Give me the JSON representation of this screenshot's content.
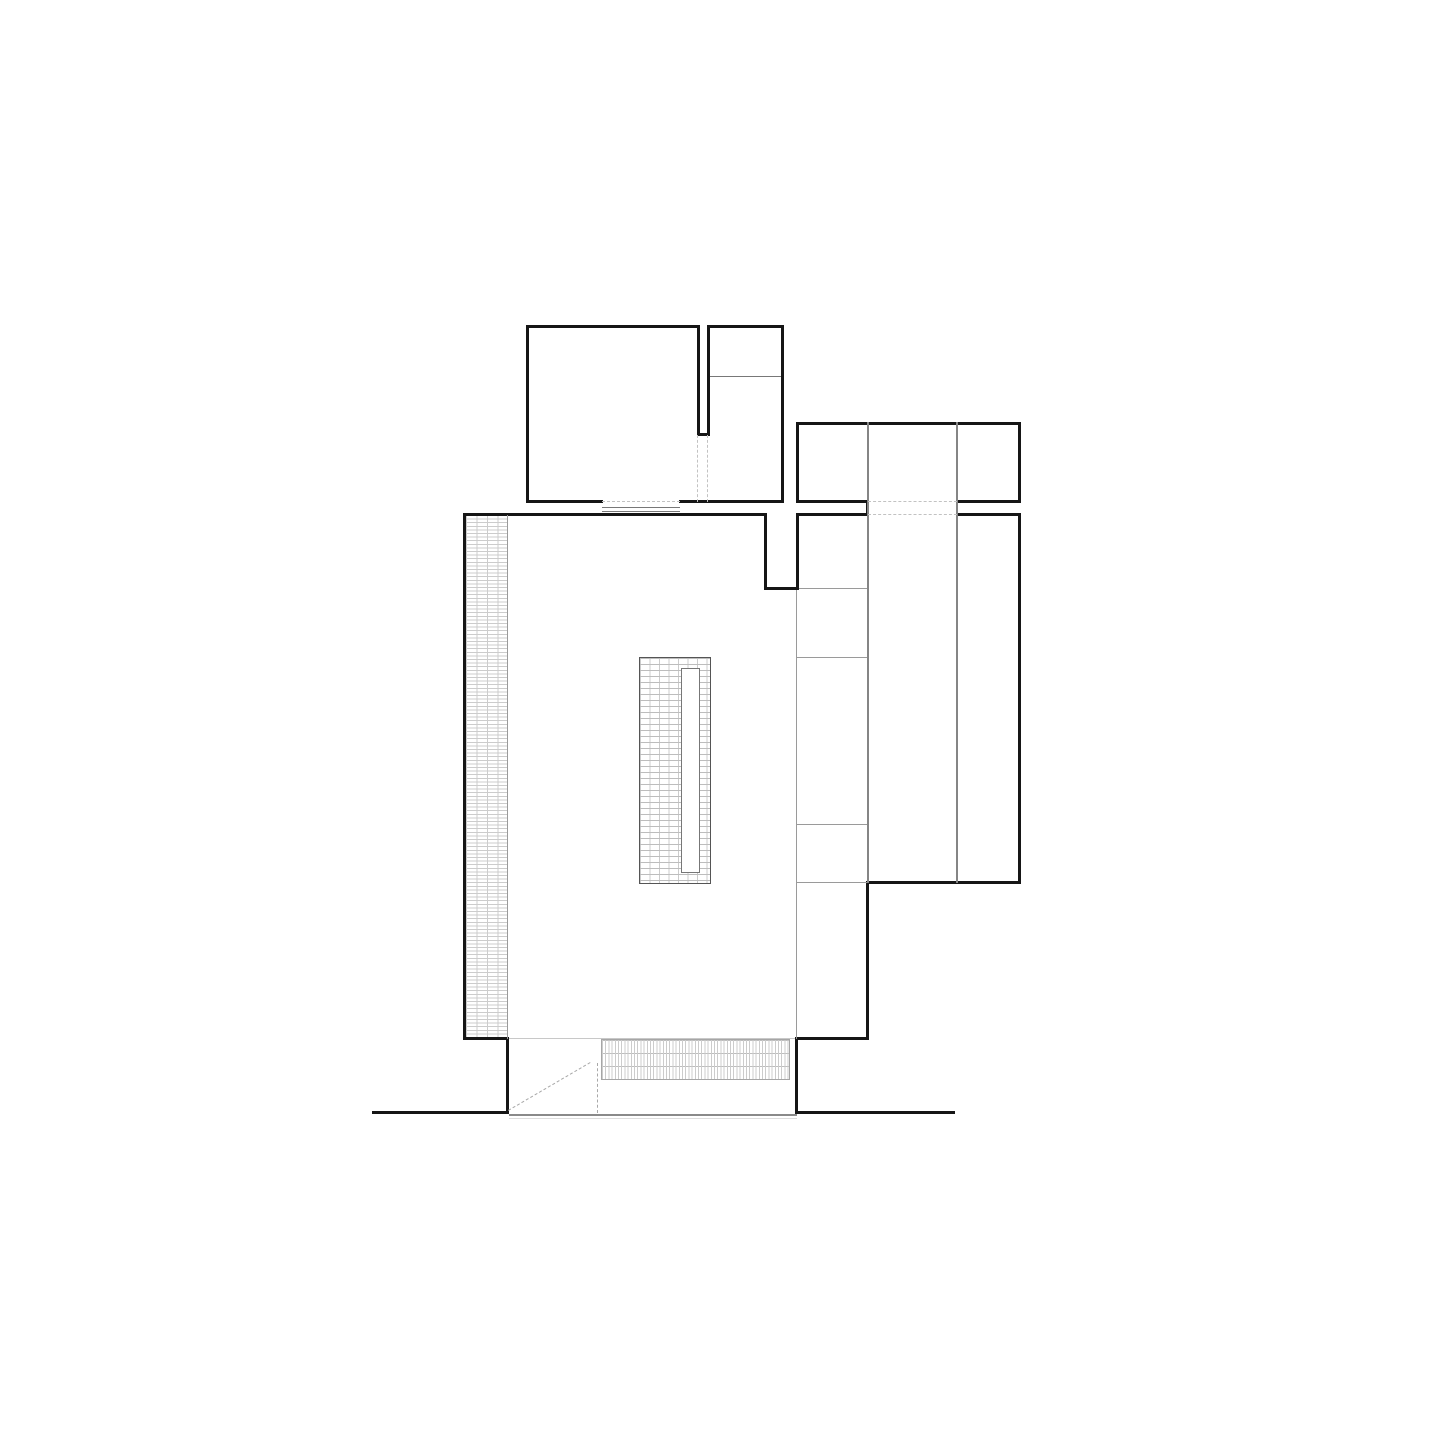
{
  "plan": {
    "canvas": {
      "w": 1440,
      "h": 1440,
      "bg": "#ffffff"
    },
    "styles": {
      "wall_color": "#161616",
      "medium_color": "#858585",
      "thin_color": "#9a9a9a",
      "thin2_color": "#787878",
      "light_color": "#dddddd",
      "dash_color": "#c2c2c2",
      "door_color": "#a8a8a8",
      "hatch_line": "#cccccc",
      "hatch_line2": "#bdbdbd",
      "island_outline": "#555555",
      "slot_outline": "#777777",
      "threshold_color": "#8a8a8a",
      "floor_line": "#c8c8c8"
    },
    "hatches": [
      {
        "name": "west-wall-hatch",
        "t": "hatch-grid",
        "x": 466,
        "y": 515,
        "w": 42,
        "h": 524
      },
      {
        "name": "entry-floor-hatch",
        "t": "hatch-vbands",
        "x": 601,
        "y": 1039,
        "w": 189,
        "h": 41
      },
      {
        "name": "island-hatch",
        "t": "hatch-brick",
        "x": 639,
        "y": 657,
        "w": 72,
        "h": 227
      },
      {
        "name": "island-slot",
        "t": "slot",
        "x": 681,
        "y": 668,
        "w": 19,
        "h": 205
      }
    ],
    "segments": [
      {
        "name": "room-nw-top-wall-west",
        "t": "wall",
        "x": 526,
        "y": 325,
        "w": 174,
        "h": 3
      },
      {
        "name": "room-nw-top-wall-east",
        "t": "wall",
        "x": 707,
        "y": 325,
        "w": 77,
        "h": 3
      },
      {
        "name": "room-nw-west-wall",
        "t": "wall",
        "x": 526,
        "y": 325,
        "w": 3,
        "h": 178
      },
      {
        "name": "room-nw-east-wall",
        "t": "wall",
        "x": 781,
        "y": 325,
        "w": 3,
        "h": 178
      },
      {
        "name": "room-nw-south-wall-west",
        "t": "wall",
        "x": 526,
        "y": 500,
        "w": 77,
        "h": 3
      },
      {
        "name": "room-nw-south-wall-east",
        "t": "wall",
        "x": 679,
        "y": 500,
        "w": 105,
        "h": 3
      },
      {
        "name": "room-nw-slot-west-wall",
        "t": "wall",
        "x": 697,
        "y": 325,
        "w": 3,
        "h": 110
      },
      {
        "name": "room-nw-slot-east-wall",
        "t": "wall",
        "x": 707,
        "y": 325,
        "w": 3,
        "h": 110
      },
      {
        "name": "room-nw-slot-end-wall",
        "t": "wall",
        "x": 697,
        "y": 433,
        "w": 13,
        "h": 3
      },
      {
        "name": "room-nw-divider-line",
        "t": "thin2",
        "x": 710,
        "y": 376,
        "w": 71,
        "h": 1
      },
      {
        "name": "block-ne-top-wall",
        "t": "wall",
        "x": 796,
        "y": 422,
        "w": 225,
        "h": 3
      },
      {
        "name": "block-ne-west-wall",
        "t": "wall",
        "x": 796,
        "y": 422,
        "w": 3,
        "h": 81
      },
      {
        "name": "block-ne-east-wall",
        "t": "wall",
        "x": 1018,
        "y": 422,
        "w": 3,
        "h": 81
      },
      {
        "name": "block-ne-south-wall-west",
        "t": "wall",
        "x": 796,
        "y": 500,
        "w": 72,
        "h": 3
      },
      {
        "name": "block-ne-south-wall-east",
        "t": "wall",
        "x": 956,
        "y": 500,
        "w": 65,
        "h": 3
      },
      {
        "name": "passage-end-cap",
        "t": "wall",
        "x": 866,
        "y": 500,
        "w": 3,
        "h": 16
      },
      {
        "name": "main-top-wall",
        "t": "wall",
        "x": 463,
        "y": 513,
        "w": 304,
        "h": 3
      },
      {
        "name": "notch-west-wall",
        "t": "wall",
        "x": 764,
        "y": 513,
        "w": 3,
        "h": 77
      },
      {
        "name": "notch-south-wall",
        "t": "wall",
        "x": 764,
        "y": 587,
        "w": 35,
        "h": 3
      },
      {
        "name": "notch-east-wall",
        "t": "wall",
        "x": 796,
        "y": 513,
        "w": 3,
        "h": 77
      },
      {
        "name": "main-top-wall-east-1",
        "t": "wall",
        "x": 796,
        "y": 513,
        "w": 72,
        "h": 3
      },
      {
        "name": "main-top-wall-east-2",
        "t": "wall",
        "x": 956,
        "y": 513,
        "w": 65,
        "h": 3
      },
      {
        "name": "main-west-wall",
        "t": "wall",
        "x": 463,
        "y": 513,
        "w": 3,
        "h": 527
      },
      {
        "name": "west-wall-foot",
        "t": "wall",
        "x": 463,
        "y": 1037,
        "w": 46,
        "h": 3
      },
      {
        "name": "entry-west-jamb",
        "t": "wall",
        "x": 506,
        "y": 1037,
        "w": 3,
        "h": 77
      },
      {
        "name": "entry-east-jamb",
        "t": "wall",
        "x": 795,
        "y": 1037,
        "w": 3,
        "h": 77
      },
      {
        "name": "main-south-wall-east",
        "t": "wall",
        "x": 795,
        "y": 1037,
        "w": 74,
        "h": 3
      },
      {
        "name": "east-wall-lower",
        "t": "wall",
        "x": 866,
        "y": 881,
        "w": 3,
        "h": 159
      },
      {
        "name": "wing-south-wall",
        "t": "wall",
        "x": 866,
        "y": 881,
        "w": 155,
        "h": 3
      },
      {
        "name": "wing-east-wall",
        "t": "wall",
        "x": 1018,
        "y": 513,
        "w": 3,
        "h": 371
      },
      {
        "name": "ground-line-west",
        "t": "wall",
        "x": 372,
        "y": 1111,
        "w": 137,
        "h": 3
      },
      {
        "name": "ground-line-east",
        "t": "wall",
        "x": 797,
        "y": 1111,
        "w": 158,
        "h": 3
      },
      {
        "name": "wing-column-line-west",
        "t": "med",
        "x": 867,
        "y": 422,
        "w": 2,
        "h": 461
      },
      {
        "name": "wing-column-line-east",
        "t": "med",
        "x": 956,
        "y": 422,
        "w": 2,
        "h": 461
      },
      {
        "name": "entry-threshold",
        "t": "thresh",
        "x": 509,
        "y": 1114,
        "w": 288,
        "h": 2
      },
      {
        "name": "entry-threshold-outer",
        "t": "light",
        "x": 509,
        "y": 1118,
        "w": 288,
        "h": 1
      },
      {
        "name": "wing-partition-589",
        "t": "thin",
        "x": 799,
        "y": 588,
        "w": 68,
        "h": 1
      },
      {
        "name": "wing-partition-658",
        "t": "thin",
        "x": 797,
        "y": 657,
        "w": 70,
        "h": 1
      },
      {
        "name": "wing-partition-825",
        "t": "thin",
        "x": 797,
        "y": 824,
        "w": 70,
        "h": 1
      },
      {
        "name": "wing-partition-883",
        "t": "thin",
        "x": 797,
        "y": 882,
        "w": 70,
        "h": 1
      },
      {
        "name": "hall-partition-line",
        "t": "thin",
        "x": 796,
        "y": 590,
        "w": 1,
        "h": 449
      },
      {
        "name": "west-wall-inner-face",
        "t": "thin",
        "x": 507,
        "y": 515,
        "w": 1,
        "h": 524
      },
      {
        "name": "north-door-sill-upper",
        "t": "thin2",
        "x": 602,
        "y": 507,
        "w": 78,
        "h": 1
      },
      {
        "name": "north-door-sill-lower",
        "t": "thin2",
        "x": 602,
        "y": 511,
        "w": 78,
        "h": 1
      },
      {
        "name": "south-floor-line",
        "t": "floor",
        "x": 509,
        "y": 1038,
        "w": 286,
        "h": 1
      },
      {
        "name": "slot-opening-dash-west",
        "t": "dash-v",
        "x": 697,
        "y": 435,
        "h": 67
      },
      {
        "name": "slot-opening-dash-east",
        "t": "dash-v",
        "x": 707,
        "y": 435,
        "h": 67
      },
      {
        "name": "room-opening-dash",
        "t": "dash-h",
        "x": 602,
        "y": 501,
        "w": 78
      },
      {
        "name": "passage-opening-dash-top",
        "t": "dash-h",
        "x": 868,
        "y": 501,
        "w": 89
      },
      {
        "name": "passage-opening-dash-bot",
        "t": "dash-h",
        "x": 868,
        "y": 514,
        "w": 89
      },
      {
        "name": "door-leaf-dash",
        "t": "door-v",
        "x": 597,
        "y": 1063,
        "h": 50
      },
      {
        "name": "door-swing-dash",
        "t": "door-diag",
        "x": 508,
        "y": 1110,
        "len": 95,
        "deg": -30.3
      }
    ]
  }
}
